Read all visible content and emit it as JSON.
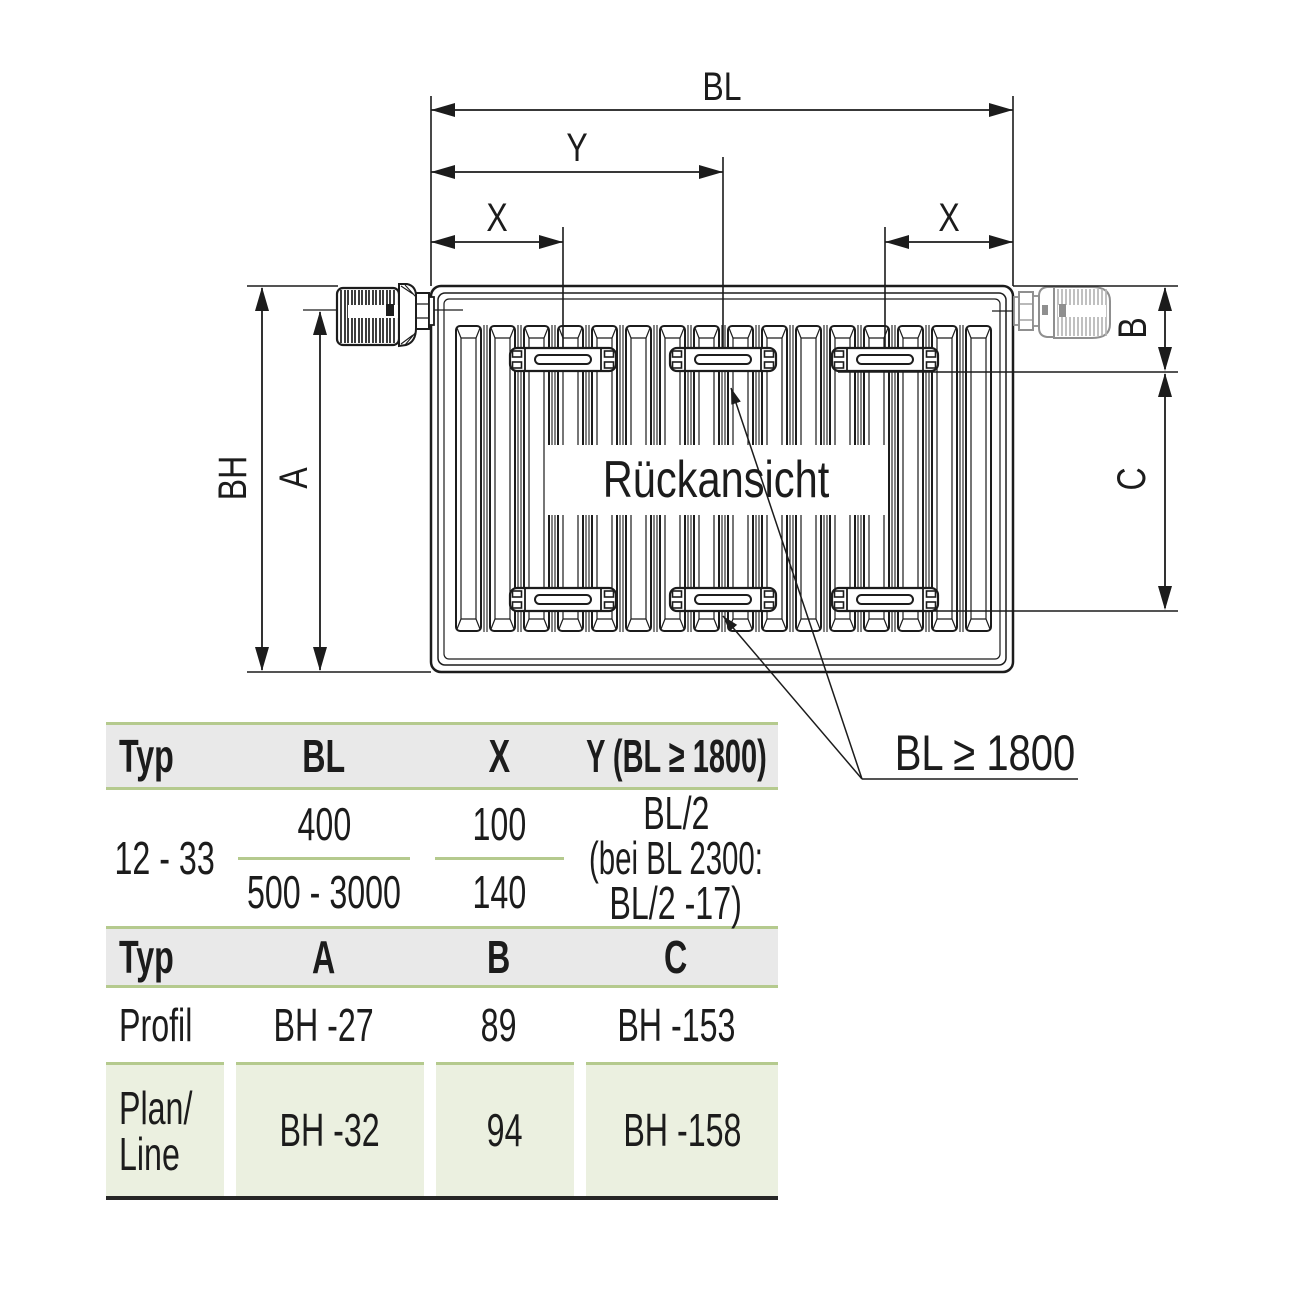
{
  "colors": {
    "line": "#1c1c1c",
    "accent_green": "#b5ca8e",
    "row_green_bg": "#ebf0e0",
    "header_gray_bg": "#e9e9e9",
    "valve_gray": "#8f8f8f"
  },
  "diagram": {
    "view_label": "Rückansicht",
    "callout": "BL ≥ 1800",
    "labels": {
      "bl": "BL",
      "y": "Y",
      "x": "X",
      "bh": "BH",
      "a": "A",
      "b": "B",
      "c": "C"
    }
  },
  "table_mounting": {
    "headers": {
      "typ": "Typ",
      "bl": "BL",
      "x": "X",
      "y": "Y (BL ≥ 1800)"
    },
    "row": {
      "typ": "12 - 33",
      "bl_top": "400",
      "bl_bottom": "500 - 3000",
      "x_top": "100",
      "x_bottom": "140",
      "y_line1": "BL/2",
      "y_line2": "(bei BL 2300:",
      "y_line3": "BL/2 -17)"
    }
  },
  "table_types": {
    "headers": {
      "typ": "Typ",
      "a": "A",
      "b": "B",
      "c": "C"
    },
    "profil": {
      "typ": "Profil",
      "a": "BH -27",
      "b": "89",
      "c": "BH -153"
    },
    "plan_line": {
      "typ_line1": "Plan/",
      "typ_line2": "Line",
      "a": "BH -32",
      "b": "94",
      "c": "BH -158"
    }
  }
}
